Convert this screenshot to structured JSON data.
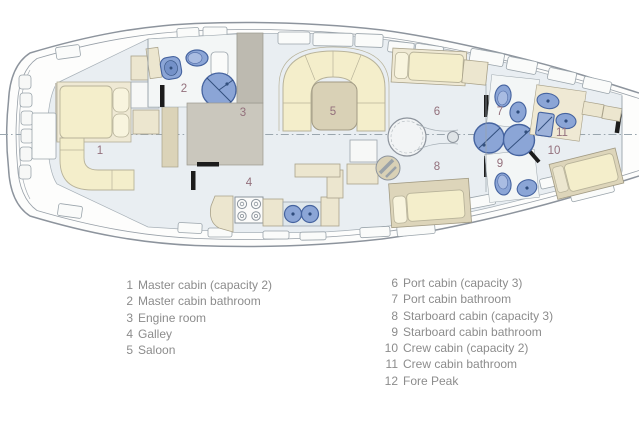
{
  "plan": {
    "labels": [
      "1",
      "2",
      "3",
      "4",
      "5",
      "6",
      "7",
      "8",
      "9",
      "10",
      "11"
    ]
  },
  "legend": {
    "left": [
      {
        "num": "1",
        "label": "Master cabin (capacity 2)"
      },
      {
        "num": "2",
        "label": "Master cabin bathroom"
      },
      {
        "num": "3",
        "label": "Engine room"
      },
      {
        "num": "4",
        "label": "Galley"
      },
      {
        "num": "5",
        "label": "Saloon"
      }
    ],
    "right": [
      {
        "num": "6",
        "label": "Port cabin (capacity 3)"
      },
      {
        "num": "7",
        "label": "Port cabin bathroom"
      },
      {
        "num": "8",
        "label": "Starboard cabin (capacity 3)"
      },
      {
        "num": "9",
        "label": "Starboard cabin bathroom"
      },
      {
        "num": "10",
        "label": "Crew cabin (capacity 2)"
      },
      {
        "num": "11",
        "label": "Crew cabin bathroom"
      },
      {
        "num": "12",
        "label": "Fore Peak"
      }
    ]
  },
  "colors": {
    "fixture_blue": "#8ba5d6",
    "fixture_blue_dark": "#45639f",
    "furniture_cream": "#f4eecb",
    "furniture_tan": "#d9d1b6",
    "engine_room_gray": "#c6c3b9",
    "floor": "#e9eef2",
    "hull_line": "#8d949d",
    "wall_mark_black": "#1c1c1c",
    "room_number_text": "#93707c",
    "legend_text": "#8c8c8c"
  }
}
